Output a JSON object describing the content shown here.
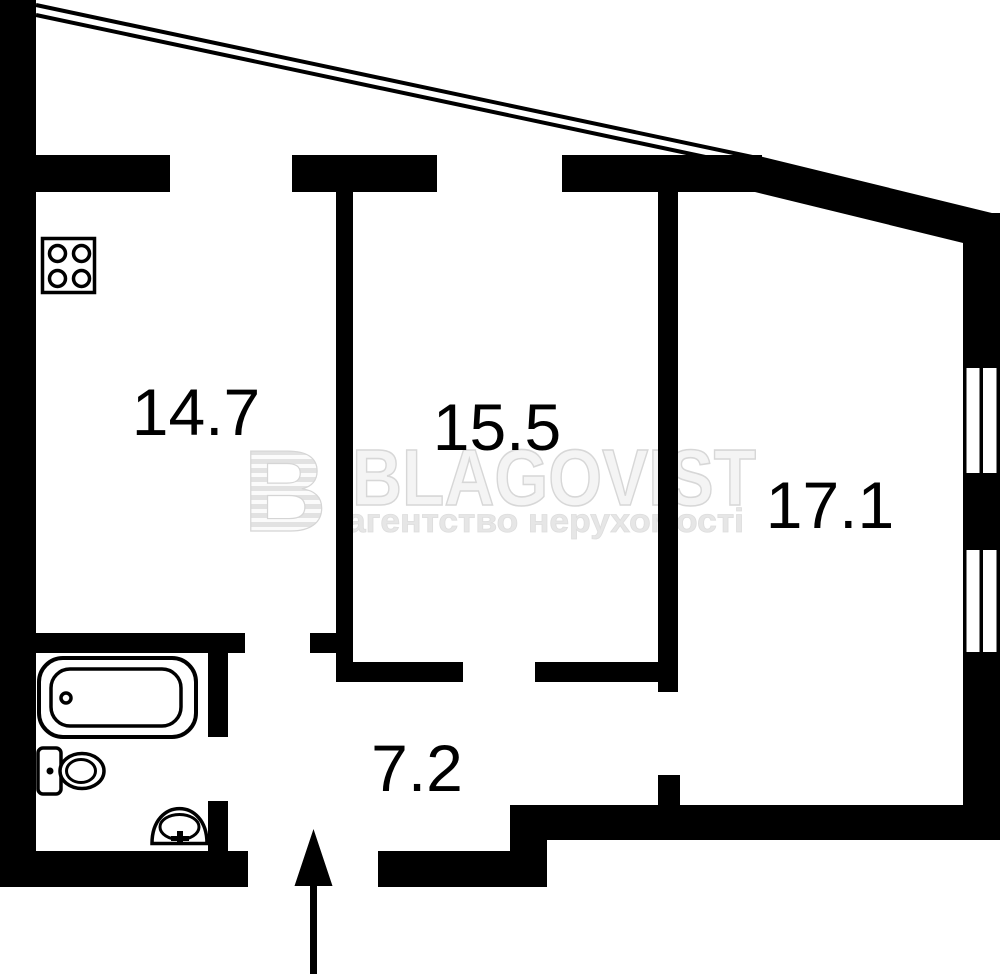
{
  "watermark": {
    "logo_letter": "B",
    "brand": "BLAGOVIST",
    "tagline": "агентство нерухомості"
  },
  "rooms": {
    "kitchen": {
      "area": "14.7"
    },
    "room_middle": {
      "area": "15.5"
    },
    "room_right": {
      "area": "17.1"
    },
    "hallway": {
      "area": "7.2"
    }
  },
  "colors": {
    "wall": "#000000",
    "background": "#ffffff",
    "watermark_fill": "#f4f4f4",
    "watermark_outline": "#d7d7d7",
    "watermark_tagline": "#e6e6e6"
  },
  "icons": {
    "stove": "stove-icon",
    "bathtub": "bathtub-icon",
    "toilet": "toilet-icon",
    "sink": "sink-icon",
    "window": "window-icon",
    "entrance_arrow": "entrance-arrow-icon",
    "balcony_boundary": "balcony-line-icon"
  }
}
